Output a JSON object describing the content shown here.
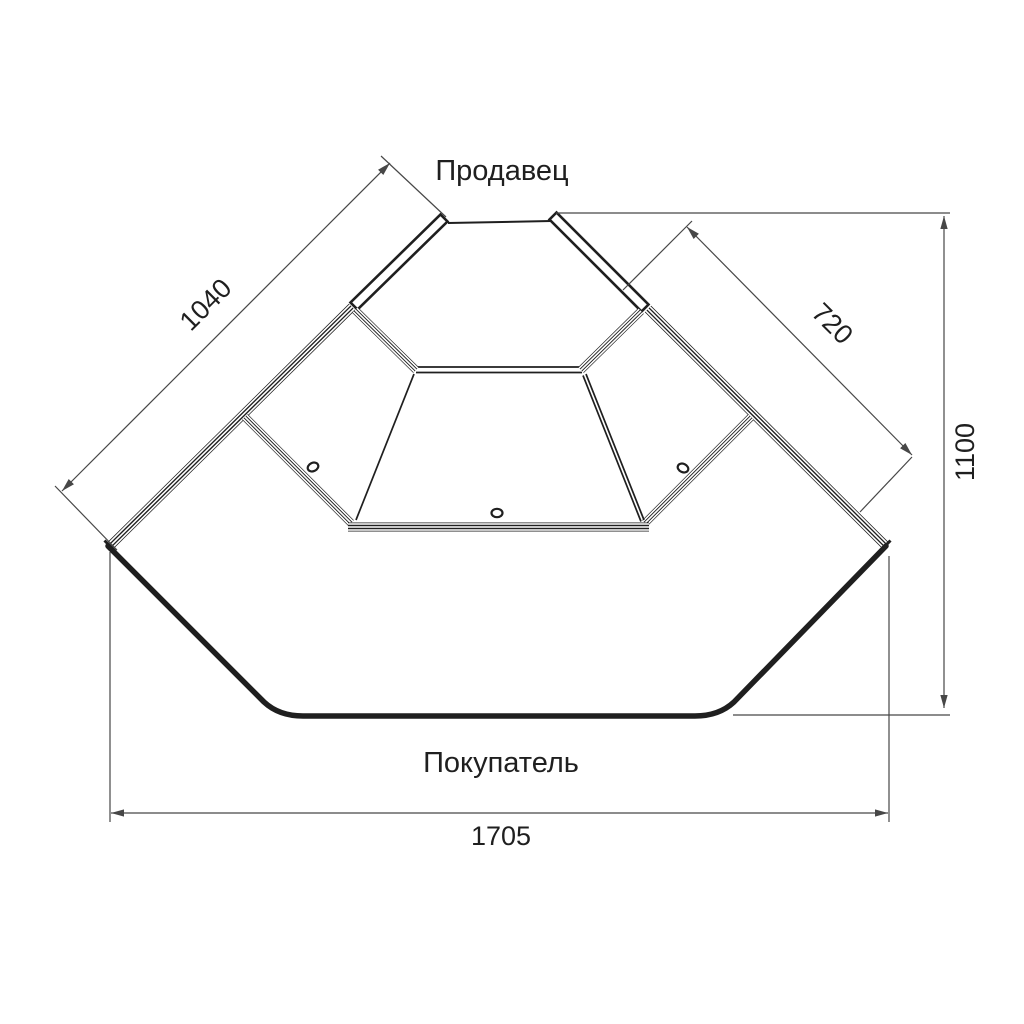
{
  "labels": {
    "seller": "Продавец",
    "buyer": "Покупатель"
  },
  "dimensions": {
    "left_side": "1040",
    "right_side": "720",
    "depth": "1100",
    "width": "1705"
  },
  "colors": {
    "line": "#1f1f1f",
    "dimension_line": "#474747",
    "background": "#ffffff"
  }
}
